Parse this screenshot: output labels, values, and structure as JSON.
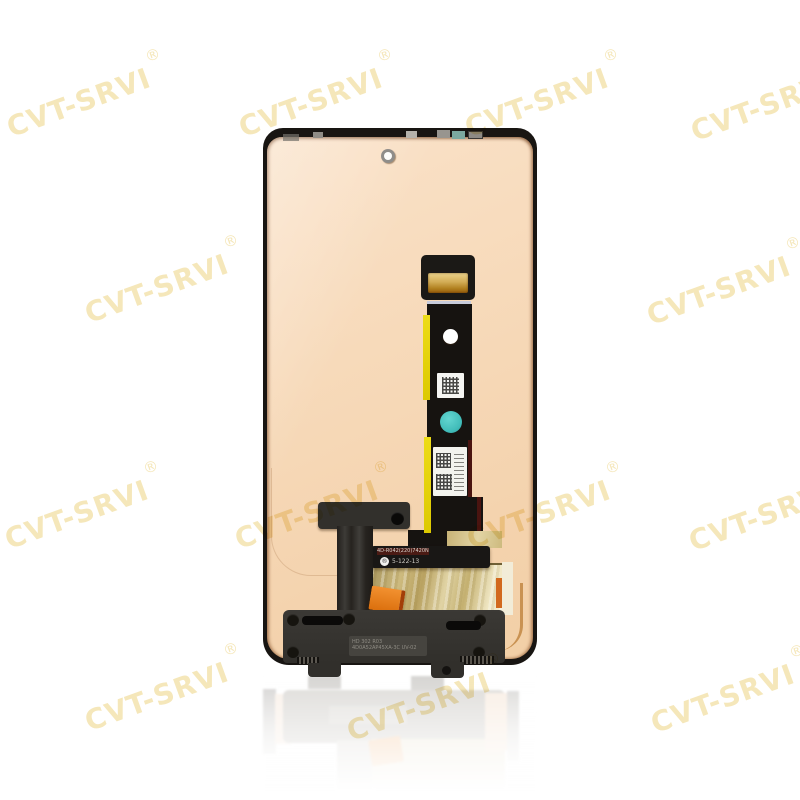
{
  "background_color": "#ffffff",
  "watermark": {
    "text": "CVT-SRVI",
    "registered_symbol": "®",
    "color": "#F5E7BA"
  },
  "product": {
    "markings": {
      "flex_bar_line1": "4D-R042(220)7420N-02",
      "flex_bar_symbol": "®",
      "flex_bar_line2": "5-122-13",
      "bracket_plate_line1": "HD 302 R03",
      "bracket_plate_line2": "4D0A52AP45XA-3C UV-02"
    },
    "colors": {
      "panel_peach": "#F6D8B8",
      "frame_black": "#181512",
      "bracket_gray": "#34322E",
      "foil_tan": "#D6C492",
      "orange_tab": "#E8831F",
      "teal_sticker": "#4CC7C3",
      "yellow_flex_edge": "#E5D30C",
      "gold_connector": "#C9A24C",
      "red_flex_stripe": "#4A1410"
    }
  }
}
